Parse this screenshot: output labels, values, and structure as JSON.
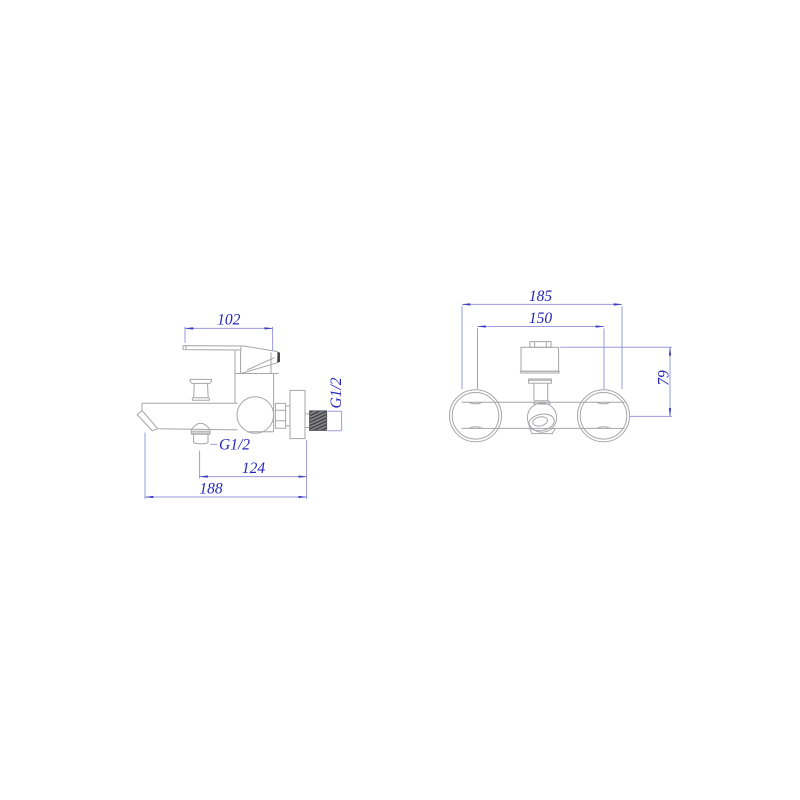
{
  "drawing": {
    "type": "faucet-installation-dimension-drawing",
    "side_view": {
      "handle_length": "102",
      "outlet_thread": "G1/2",
      "inlet_thread": "G1/2",
      "outlet_to_wall": "124",
      "overall_projection": "188"
    },
    "front_view": {
      "overall_width": "185",
      "hole_spacing": "150",
      "body_height": "79"
    },
    "colors": {
      "background": "#ffffff",
      "object_line": "#a6a6aa",
      "dimension_line": "#9a9adc",
      "dimension_text": "#2424bc",
      "arrowhead": "#3c3cc4",
      "dark_fill": "#46464a"
    }
  }
}
